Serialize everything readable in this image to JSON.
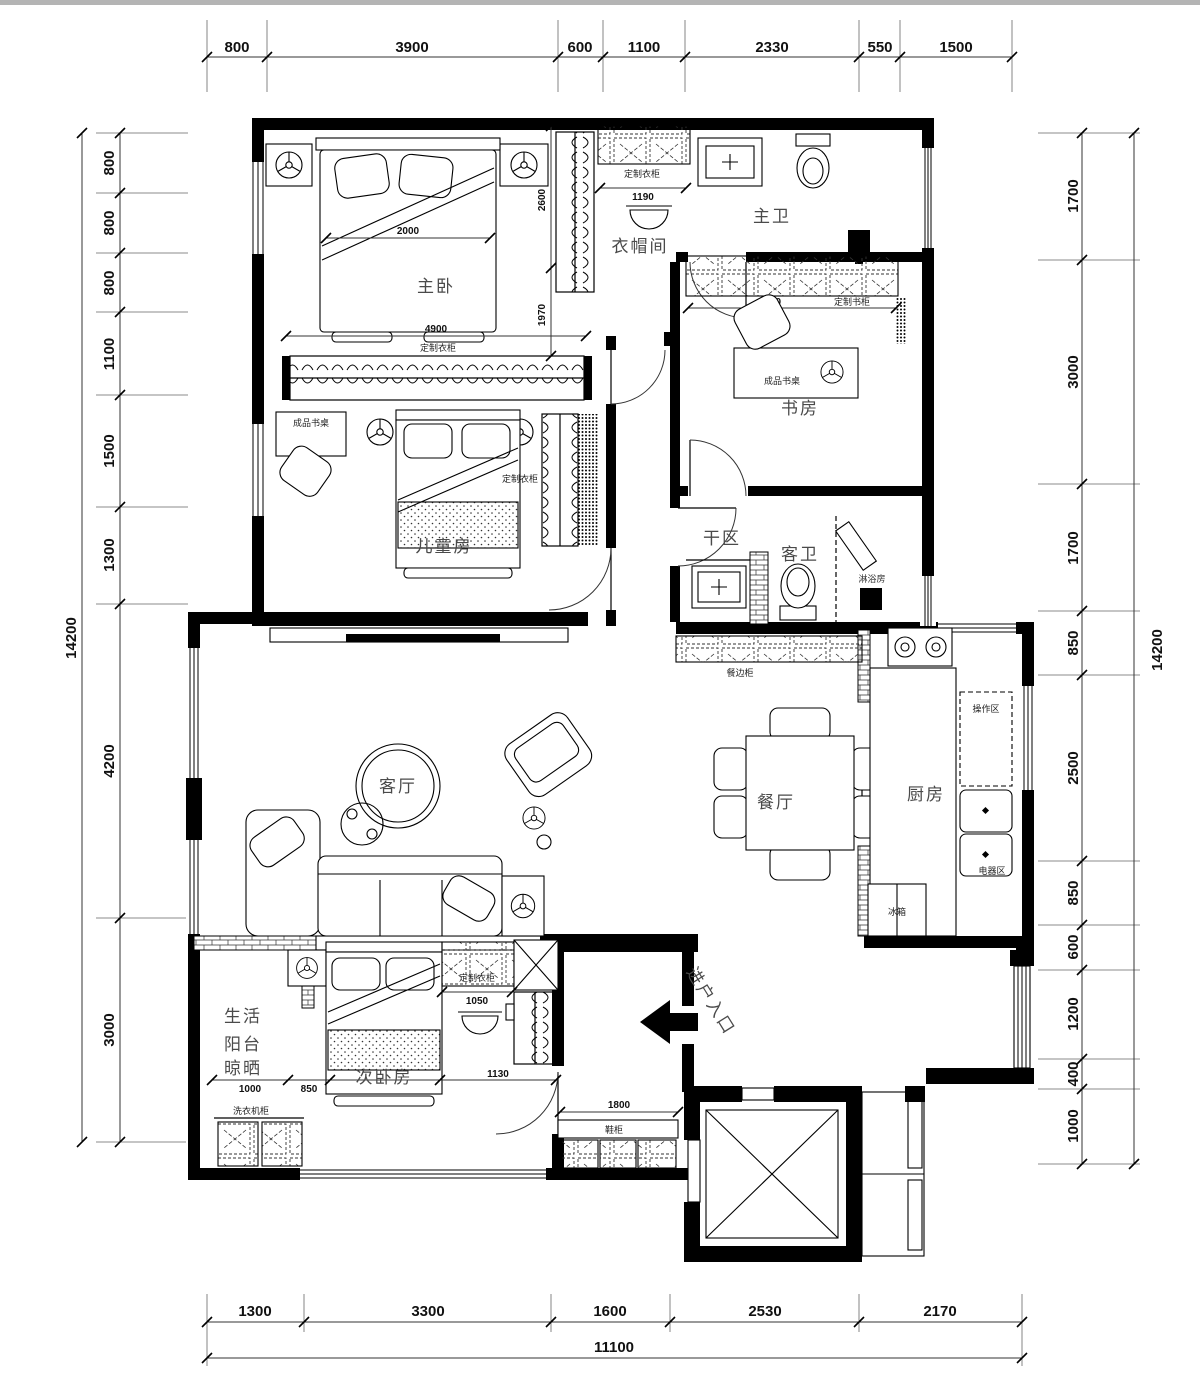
{
  "dims": {
    "top": [
      "800",
      "3900",
      "600",
      "1100",
      "2330",
      "550",
      "1500"
    ],
    "bottom": [
      "1300",
      "3300",
      "1600",
      "2530",
      "2170"
    ],
    "bottom_total": "11100",
    "left": [
      "800",
      "800",
      "800",
      "1100",
      "1500",
      "1300",
      "4200",
      "3000"
    ],
    "left_total": "14200",
    "right": [
      "1700",
      "3000",
      "1700",
      "850",
      "2500",
      "850",
      "600",
      "1200",
      "400",
      "1000"
    ],
    "right_total": "14200"
  },
  "rooms": {
    "master": "主卧",
    "cloak": "衣帽间",
    "mbath": "主卫",
    "study": "书房",
    "kids": "儿童房",
    "dry": "干区",
    "gbath": "客卫",
    "shower": "淋浴房",
    "living": "客厅",
    "dining": "餐厅",
    "kitchen": "厨房",
    "balcony1": "生活",
    "balcony2": "阳台",
    "balcony3": "晾晒",
    "bed2": "次卧房",
    "entry": "进户入口"
  },
  "ann": {
    "wardrobe": "定制衣柜",
    "bookcase": "定制书柜",
    "desk": "成品书桌",
    "sideboard": "餐边柜",
    "work": "操作区",
    "appliance": "电器区",
    "fridge": "冰箱",
    "washer": "洗衣机柜",
    "shoe": "鞋柜"
  },
  "inline": {
    "bed_w": "2000",
    "closet_w": "4900",
    "h_upper": "2600",
    "h_lower": "1970",
    "cloak_w": "1190",
    "bookcase_w": "2800",
    "wardrobe_w": "1050",
    "seg_1000": "1000",
    "seg_850": "850",
    "seg_1130": "1130",
    "shoe_w": "1800"
  }
}
